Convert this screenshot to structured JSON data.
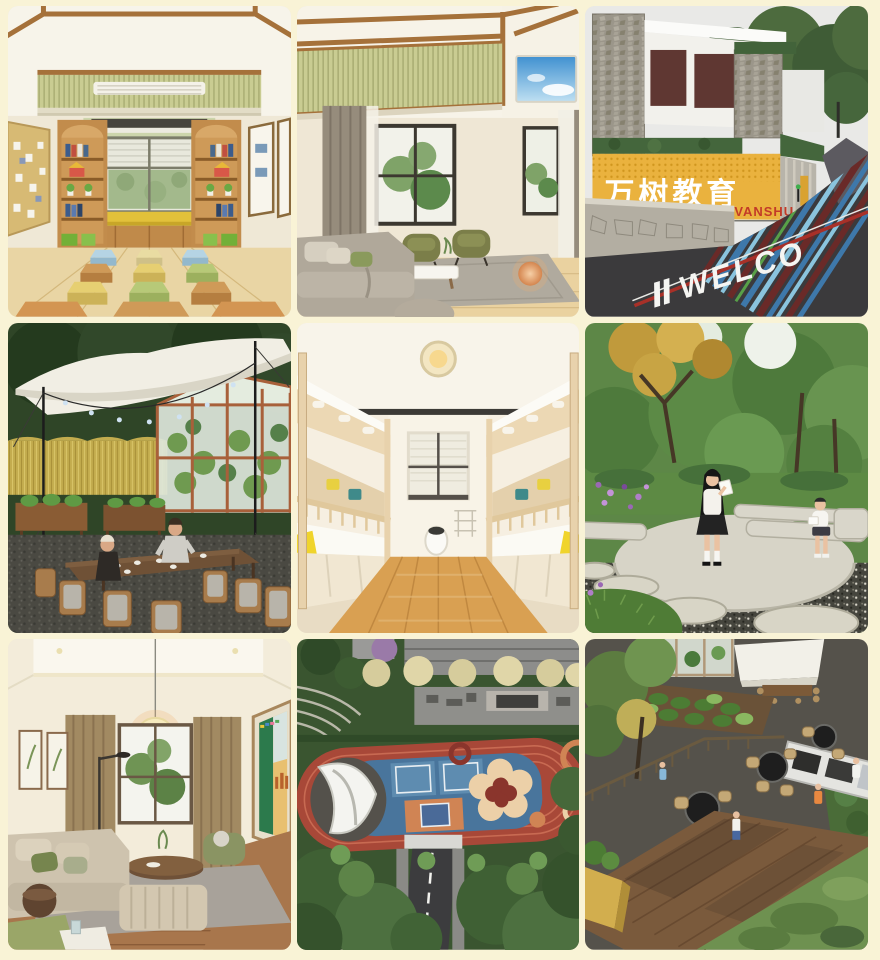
{
  "page": {
    "background": "#f9f3d6",
    "tile_corner_radius_px": 10
  },
  "gallery": {
    "tiles": [
      {
        "name": "classroom-render",
        "label": "classroom with hexagon stools and book shelves"
      },
      {
        "name": "lounge-skylight-render",
        "label": "lounge with wood beam ceiling and sky light"
      },
      {
        "name": "campus-gate-render",
        "label": "campus entrance gate with brand wall and striped road"
      },
      {
        "name": "tent-dining-render",
        "label": "outdoor canopy dining beside wheat field and greenhouse"
      },
      {
        "name": "dormitory-render",
        "label": "bunk bed dormitory in light wood"
      },
      {
        "name": "reading-garden-render",
        "label": "garden reading circle with stepping stones"
      },
      {
        "name": "living-room-render",
        "label": "living room with paper lantern and green artwork"
      },
      {
        "name": "sports-track-render",
        "label": "aerial view of running track and play courts"
      },
      {
        "name": "bbq-terrace-render",
        "label": "aerial view of barbecue terrace and garden beds"
      }
    ]
  },
  "gate": {
    "sign_cn": "万树教育",
    "brand": "VANSHU",
    "road_text": "WELCO"
  },
  "colors": {
    "gate_wall_yellow": "#e9b440",
    "brand_red": "#c23a28",
    "sign_white": "#ffffff",
    "road_text_white": "#f5f5f2"
  }
}
